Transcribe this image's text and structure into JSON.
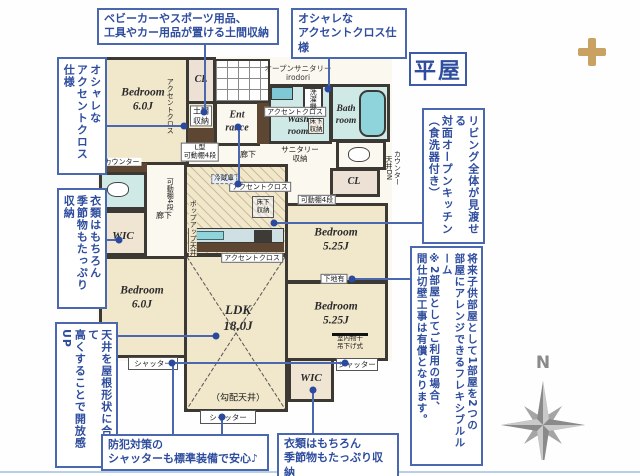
{
  "title": "平屋",
  "callouts": {
    "doma_storage": "ベビーカーやスポーツ用品、\n工具やカー用品が置ける土間収納",
    "accent_top": "オシャレな\nアクセントクロス仕様",
    "accent_left": "オシャレな\nアクセントクロス仕様",
    "clothes_left": "衣類はもちろん\n季節物もたっぷり収納",
    "ceiling_left": "天井を屋根形状に合わせて\n高くすることで開放感UP",
    "open_kitchen_right": "リビング全体が見渡せる\n対面オープンキッチン\n（食洗器付き）",
    "flexible_room_right": "将来子供部屋として1部屋を2つの\n部屋にアレンジできるフレキシブルルーム\n※2部屋としてご利用の場合、\n間仕切壁工事は有償となります。",
    "security_shutter": "防犯対策の\nシャッターも標準装備で安心♪",
    "clothes_bottom": "衣類はもちろん\n季節物もたっぷり収納"
  },
  "rooms": {
    "bedroom_nw": "Bedroom\n6.0J",
    "bedroom_sw": "Bedroom\n6.0J",
    "bedroom_ne": "Bedroom\n5.25J",
    "bedroom_se": "Bedroom\n5.25J",
    "ldk": "LDK\n18.0J",
    "entrance": "Ent\nrance",
    "wash_room": "Wash\nroom",
    "bath_room": "Bath\nroom",
    "wic_west": "WIC",
    "wic_south": "WIC",
    "cl_north": "CL",
    "cl_east": "CL"
  },
  "plan_labels": {
    "accent_cross_bedroom": "アクセントクロス",
    "doma_storage": "土間\n収納",
    "l_shelf": "L型\n可動棚4段",
    "hallway_north": "廊下",
    "hallway_west": "廊下",
    "open_sanitary": "オープンサニタリー\nirodori",
    "accent_cross_wash": "アクセントクロス",
    "washing_machine": "洗濯機",
    "underfloor_wash": "床下\n収納",
    "sanitary_storage": "サニタリー\n収納",
    "counter_ceiling_dn": "カウンター\n天井DN",
    "shelf_east": "可動棚4段",
    "shelf_west": "可動棚4段",
    "base_board": "下地有",
    "indoor_drying": "室内物干\n吊下げ式",
    "shutter_left": "シャッター",
    "shutter_bottom": "シャッター",
    "shutter_right": "シャッター",
    "sloped_ceiling": "（勾配天井）",
    "accent_cross_kitchen_n": "アクセントクロス",
    "accent_cross_kitchen_s": "アクセントクロス",
    "refrigerator": "冷蔵庫",
    "underfloor_kitchen": "床下\n収納",
    "popup_ceiling": "ポップアップ天井",
    "counter_west": "カウンター",
    "compass_n": "N"
  },
  "colors": {
    "callout_blue": "#4a68b0",
    "text_navy": "#2e4d9e",
    "wall_dark": "#3c3833",
    "room_beige": "#f1e7cb",
    "wet_cyan": "#cfe9e6",
    "tub_cyan": "#8fd4da",
    "wood_brown": "#5d4732",
    "gold_cross": "#c9a262",
    "compass_gray": "#8a8a8a"
  }
}
